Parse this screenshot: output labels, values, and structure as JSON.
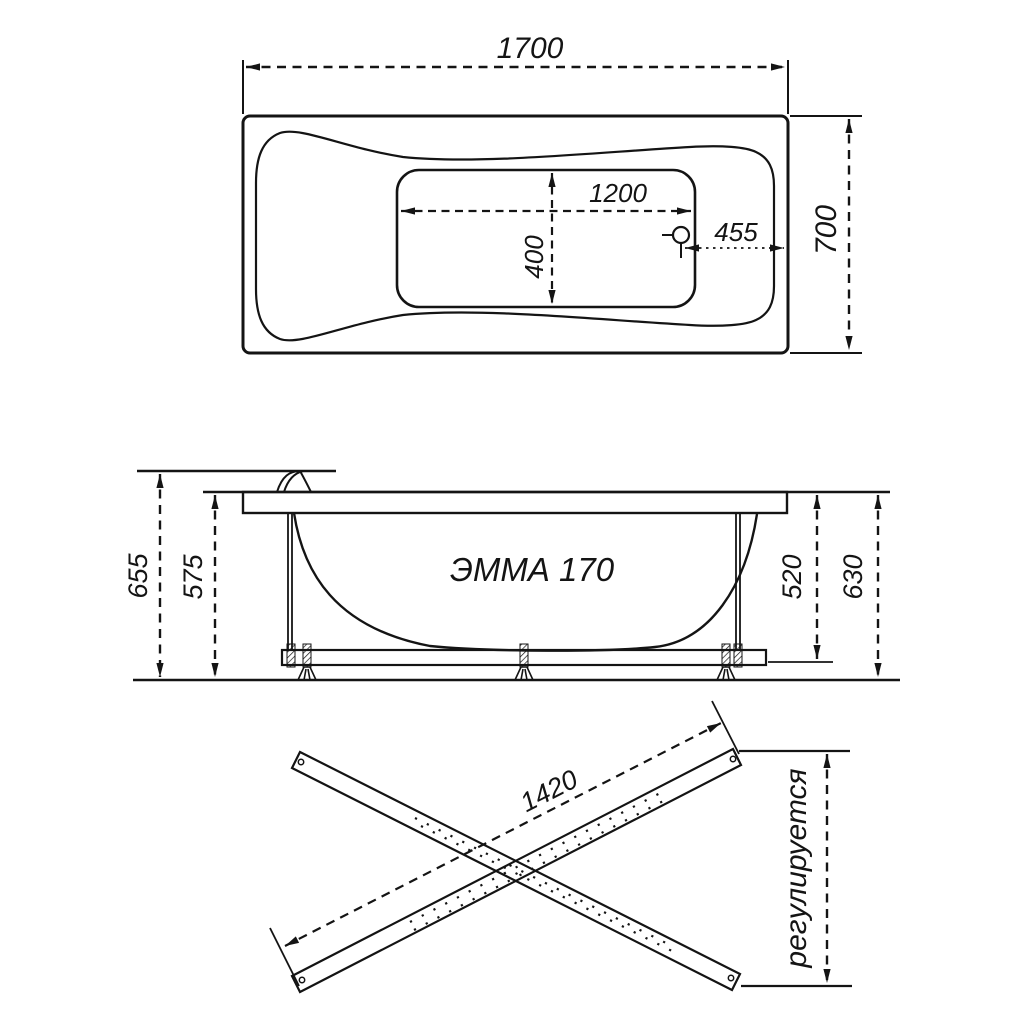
{
  "drawing": {
    "background_color": "#ffffff",
    "line_color": "#141414",
    "top_view": {
      "overall_length_label": "1700",
      "overall_width_label": "700",
      "bottom_length_label": "1200",
      "bottom_width_label": "400",
      "drain_offset_label": "455"
    },
    "side_view": {
      "model_label": "ЭММА 170",
      "total_height_label": "655",
      "rim_height_label": "575",
      "inner_height_label": "520",
      "frame_height_label": "630"
    },
    "bottom_view": {
      "crossbar_length_label": "1420",
      "adjustable_label": "регулируется"
    }
  }
}
